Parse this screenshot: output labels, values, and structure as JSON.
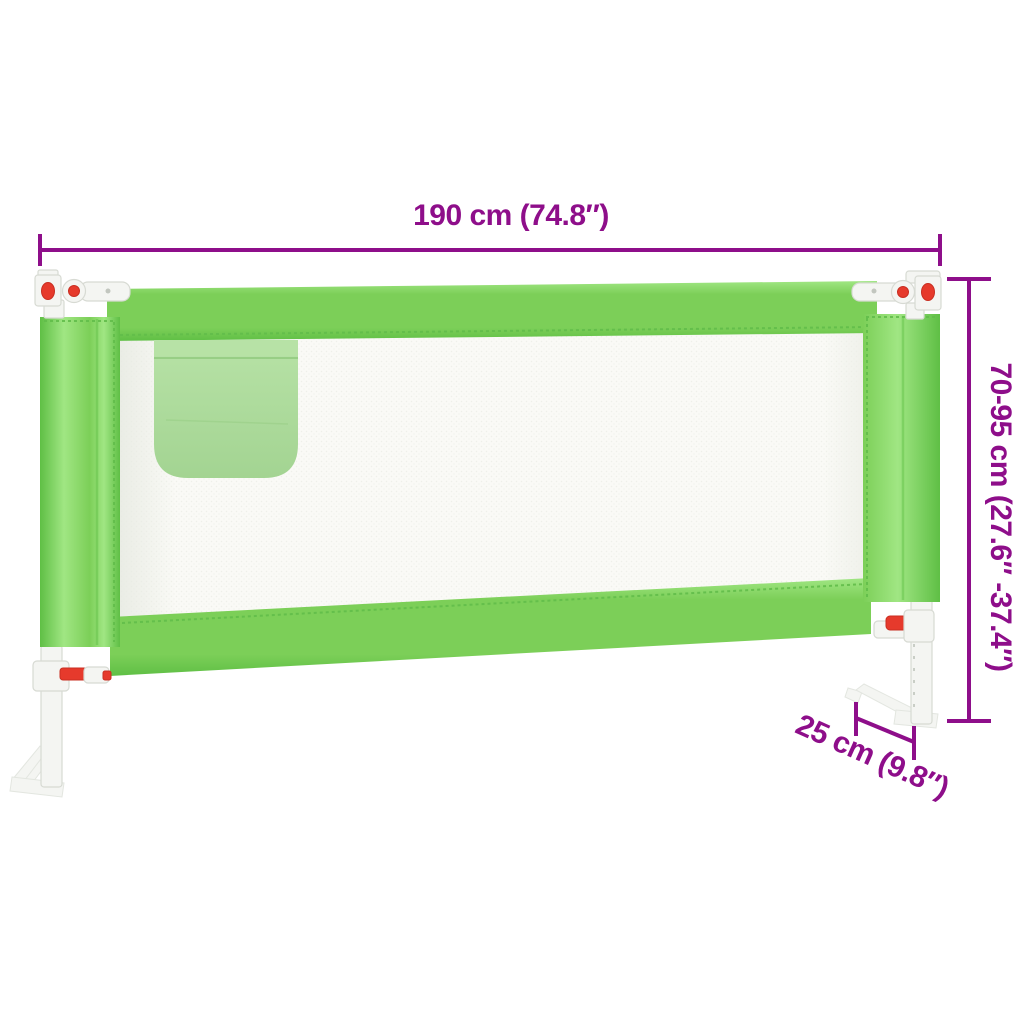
{
  "diagram": {
    "subject": "toddler-bed-rail",
    "dimensions": {
      "width": {
        "label": "190 cm (74.8″)"
      },
      "height": {
        "label": "70-95 cm (27.6″ -37.4″)"
      },
      "depth": {
        "label": "25 cm (9.8″)"
      }
    }
  },
  "colors": {
    "dimension_purple": "#8e0e8a",
    "rail_green": "#7ccf58",
    "rail_green_light": "#a0e683",
    "rail_green_dark": "#5fbf45",
    "stitch_green": "#62bd4a",
    "pocket_green": "#a3d492",
    "pocket_green_light": "#b7e2a6",
    "mesh_white": "#fafaf6",
    "metal_white": "#f4f5f2",
    "metal_shadow": "#d7dad3",
    "latch_red": "#e63a2c",
    "background": "#ffffff"
  }
}
